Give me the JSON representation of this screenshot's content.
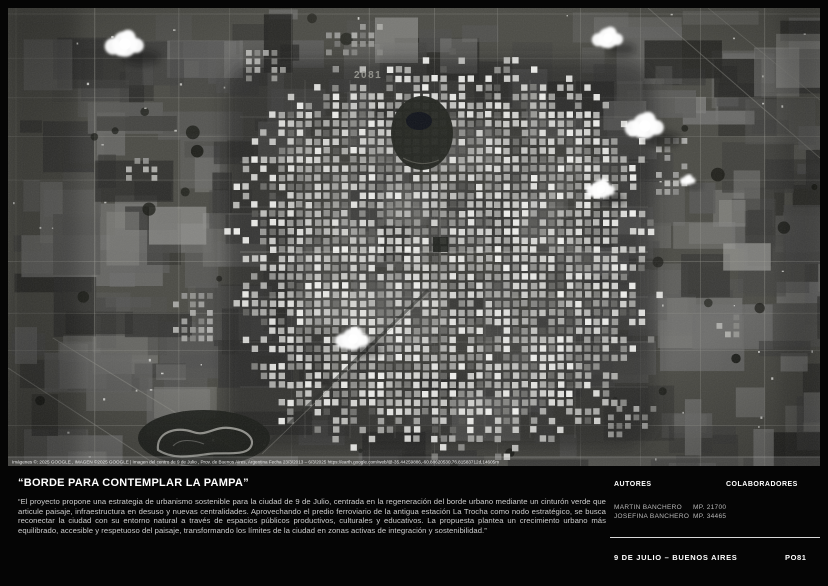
{
  "panel": {
    "title": "“BORDE PARA CONTEMPLAR LA PAMPA”",
    "description": "“El proyecto propone una estrategia de urbanismo sostenible para la ciudad de 9 de Julio, centrada en la regeneración del borde urbano mediante un cinturón verde que articule paisaje, infraestructura en desuso y nuevas centralidades. Aprovechando el predio ferroviario de la antigua estación La Trocha como nodo estratégico, se busca reconectar la ciudad con su entorno natural a través de espacios públicos productivos, culturales y educativos. La propuesta plantea un crecimiento urbano más equilibrado, accesible y respetuoso del paisaje, transformando los límites de la ciudad en zonas activas de integración y sostenibilidad.”"
  },
  "credits": {
    "autores_label": "AUTORES",
    "colaboradores_label": "COLABORADORES",
    "authors": [
      {
        "name": "MARTIN BANCHERO",
        "mp": "MP. 21700"
      },
      {
        "name": "JOSEFINA BANCHERO",
        "mp": "MP. 34465"
      }
    ]
  },
  "footer": {
    "location": "9 DE JULIO – BUENOS AIRES",
    "code": "PO81"
  },
  "satellite": {
    "watermark": "2081",
    "caption": "Imágenes ©: 2025 GOOGLE , IMAGEN ©2025 GOOGLE | Imagen del centro de 9 de Julio , Prov. de Buenos Aires, Argentina Fecha 23/3/2013 – 6/3/2025  https://earth.google.com/web/@-35.44259886,-60.88620530,76.81583712d,14605m"
  },
  "colors": {
    "background": "#050505",
    "text_primary": "#ffffff",
    "text_secondary": "#cdcdcd",
    "divider": "#d8d8d8"
  }
}
